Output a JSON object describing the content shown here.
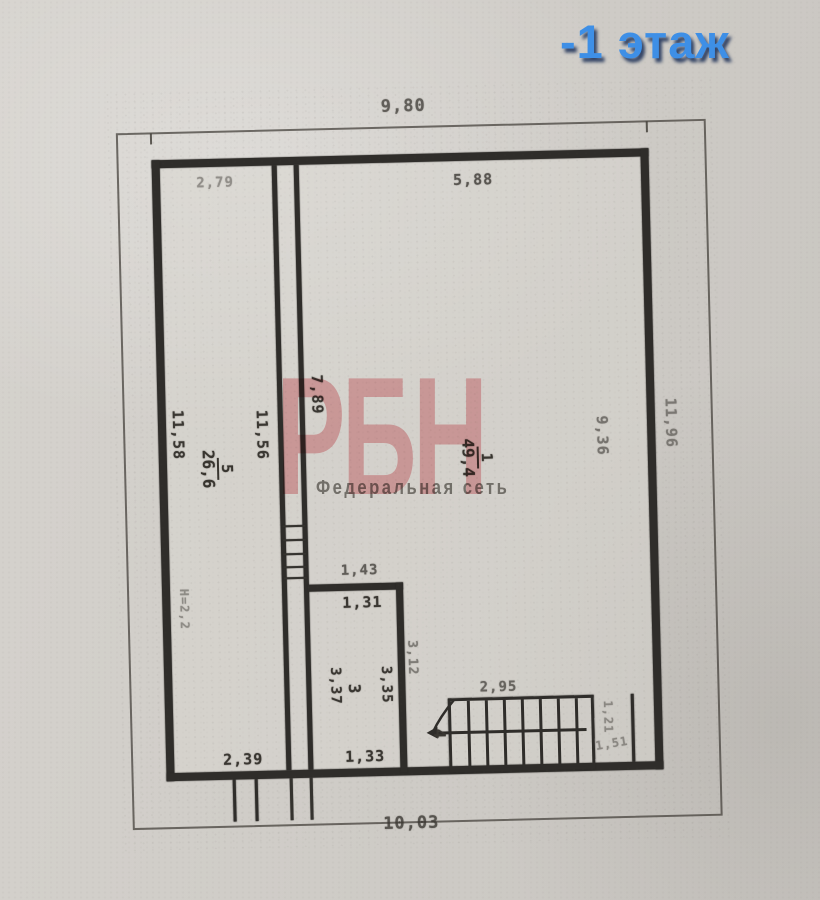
{
  "title": "-1 этаж",
  "watermark": {
    "brand": "РБН",
    "subtitle": "Федеральная сеть"
  },
  "colors": {
    "title_blue": "#3e8fe6",
    "watermark_pink": "#f0aeb3",
    "paper": "#d0cdc8",
    "ink": "#38352f"
  },
  "rooms": {
    "room1": {
      "number": "1",
      "area": "49,4"
    },
    "room5": {
      "number": "5",
      "area": "26,6"
    },
    "room3": {
      "number": "3"
    },
    "room4": {
      "number": "4"
    }
  },
  "dims": {
    "top_width": "9,80",
    "bottom_width": "10,03",
    "left_wall": "11,58",
    "right_wall": "11,96",
    "room1_top": "5,88",
    "room1_top_left": "2,79",
    "corridor_left": "11,56",
    "room1_left": "7,89",
    "room1_right": "9,36",
    "room3_top_outer": "1,43",
    "room3_top_inner": "1,31",
    "room3_left": "3,37",
    "room3_right": "3,35",
    "room3_wall_right": "3,12",
    "room3_bottom": "1,33",
    "stairs_top": "2,95",
    "stairs_right": "1,21",
    "stairs_corner": "1,51",
    "bottom_left": "2,39",
    "ceiling_height": "Н=2,2"
  }
}
